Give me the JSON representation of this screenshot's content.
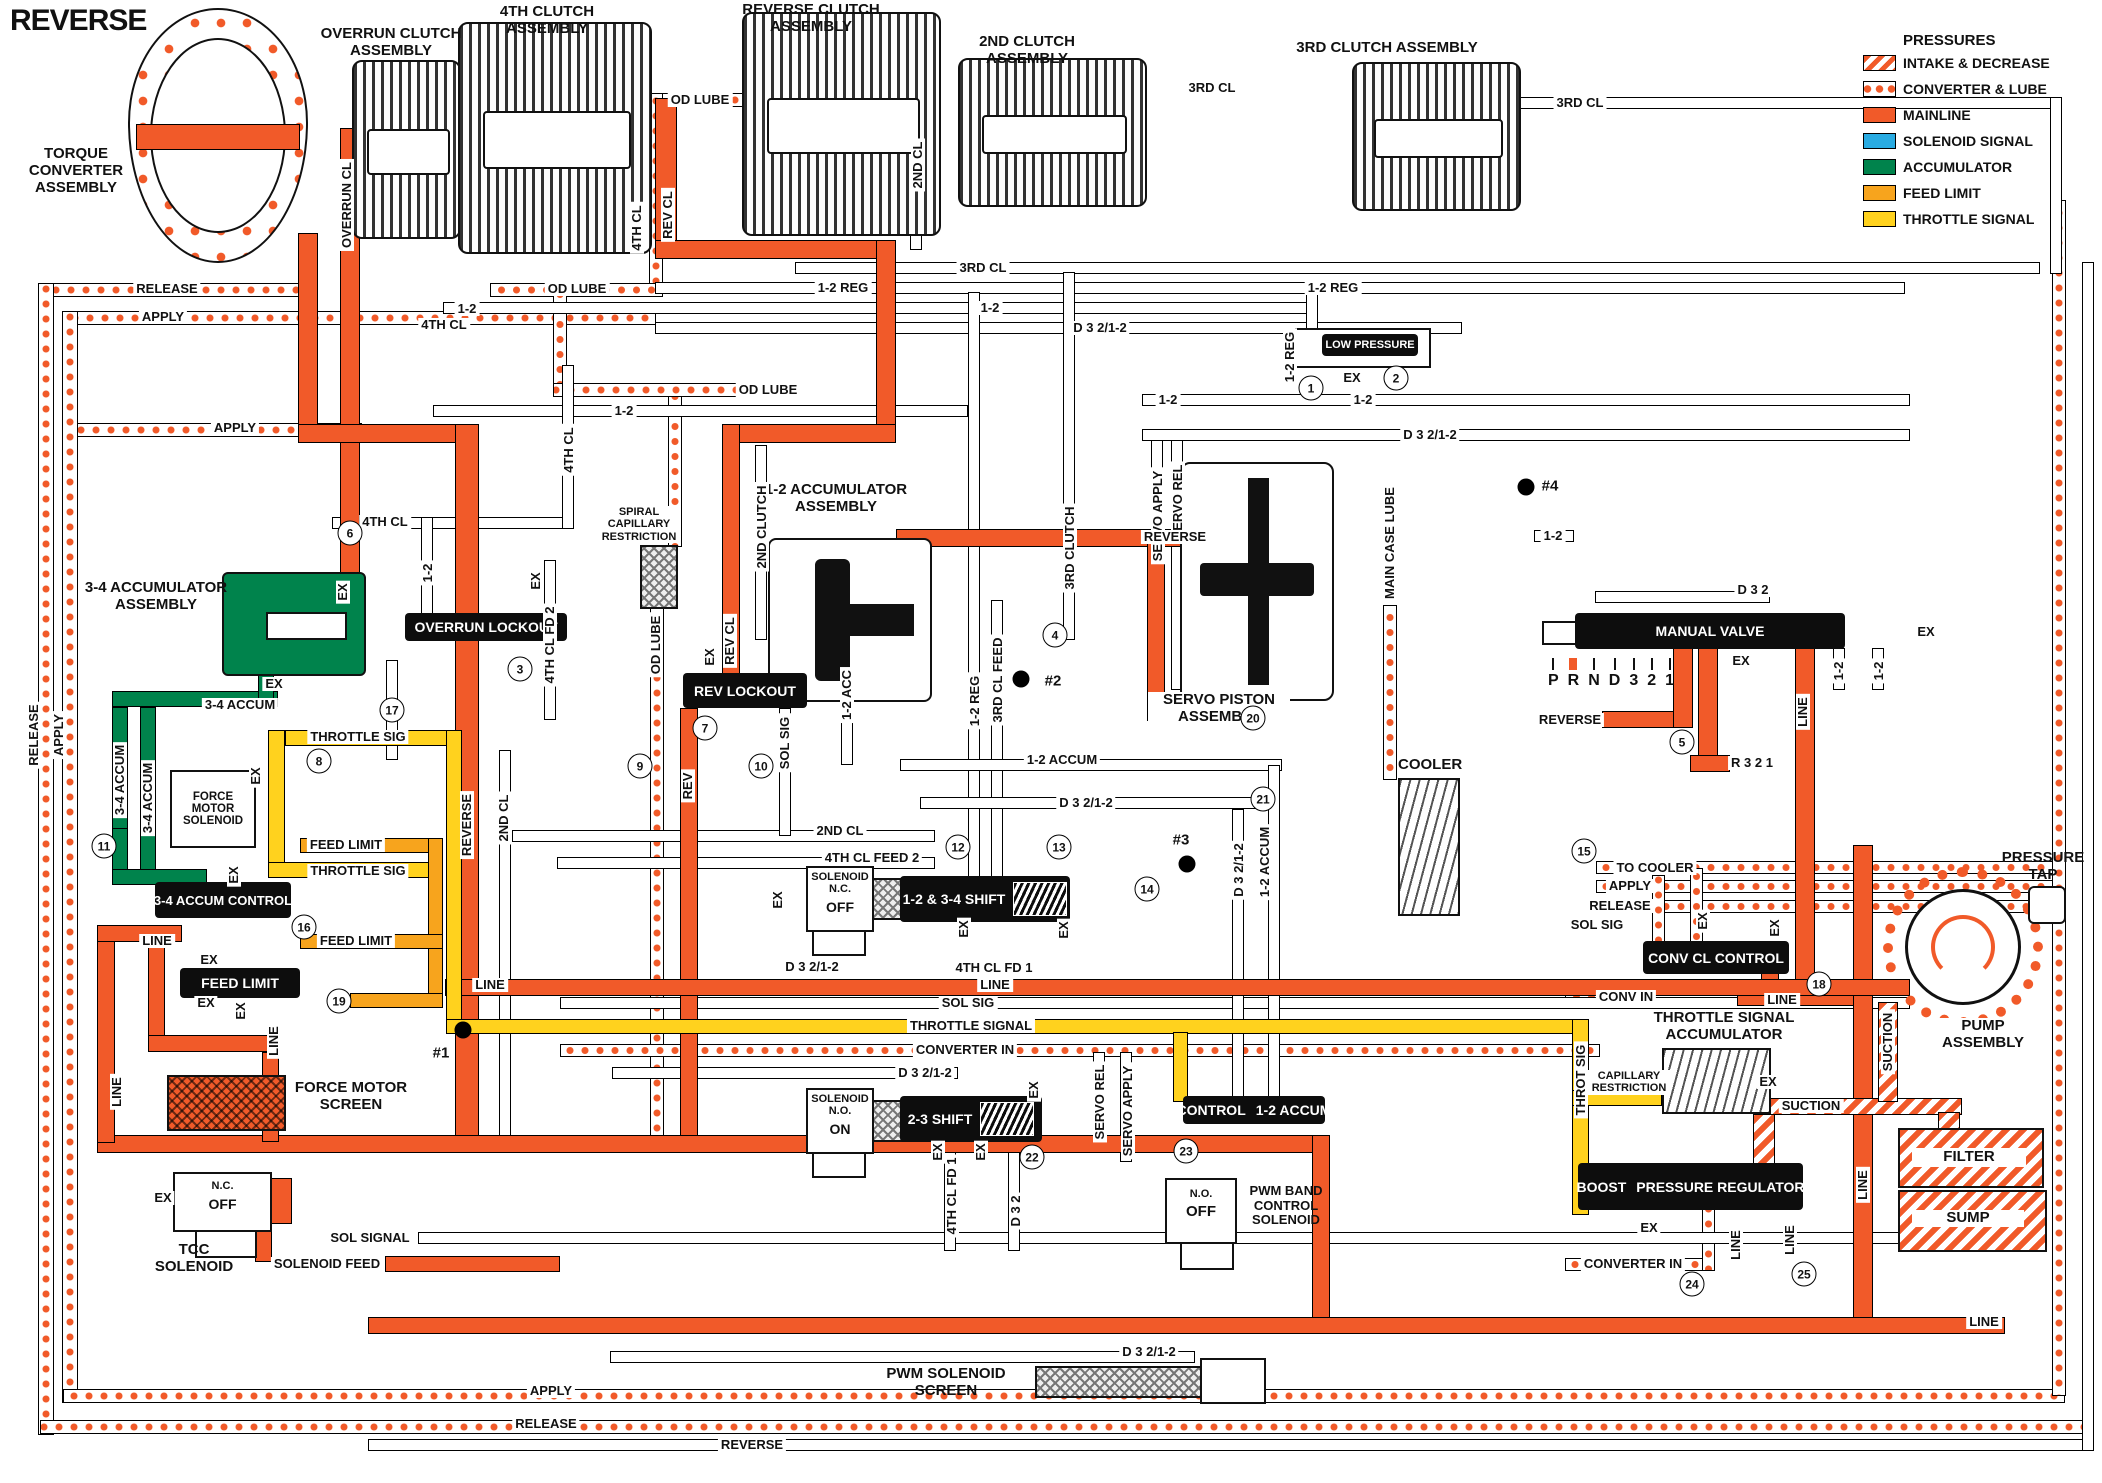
{
  "title": "REVERSE",
  "legend": {
    "title": "PRESSURES",
    "items": [
      {
        "label": "INTAKE & DECREASE",
        "type": "intake"
      },
      {
        "label": "CONVERTER & LUBE",
        "type": "conv"
      },
      {
        "label": "MAINLINE",
        "type": "main"
      },
      {
        "label": "SOLENOID SIGNAL",
        "type": "sol"
      },
      {
        "label": "ACCUMULATOR",
        "type": "accum"
      },
      {
        "label": "FEED LIMIT",
        "type": "feed"
      },
      {
        "label": "THROTTLE SIGNAL",
        "type": "throttle"
      }
    ]
  },
  "colors": {
    "mainline": "#F15A29",
    "solenoid_signal": "#29ABE2",
    "accumulator": "#00834C",
    "feed_limit": "#F7A41D",
    "throttle_signal": "#FFD21E"
  },
  "components": {
    "torque_converter": "TORQUE CONVERTER ASSEMBLY",
    "overrun_clutch": "OVERRUN CLUTCH ASSEMBLY",
    "clutch_4th": "4TH CLUTCH ASSEMBLY",
    "reverse_clutch": "REVERSE CLUTCH ASSEMBLY",
    "clutch_2nd": "2ND CLUTCH ASSEMBLY",
    "clutch_3rd": "3RD CLUTCH ASSEMBLY",
    "accum_34": "3-4 ACCUMULATOR ASSEMBLY",
    "accum_12": "1-2 ACCUMULATOR ASSEMBLY",
    "spiral_capillary": "SPIRAL CAPILLARY RESTRICTION",
    "servo_piston": "SERVO PISTON ASSEMBLY",
    "cooler": "COOLER",
    "force_motor_solenoid": "FORCE MOTOR SOLENOID",
    "force_motor_screen": "FORCE MOTOR SCREEN",
    "tcc_solenoid": "TCC SOLENOID",
    "pwm_band_solenoid": "PWM BAND CONTROL SOLENOID",
    "pwm_screen": "PWM SOLENOID SCREEN",
    "throttle_accum": "THROTTLE SIGNAL ACCUMULATOR",
    "capillary_restriction": "CAPILLARY RESTRICTION",
    "pump": "PUMP ASSEMBLY",
    "pressure_tap": "PRESSURE TAP",
    "filter": "FILTER",
    "sump": "SUMP"
  },
  "valves": {
    "overrun_lockout": "OVERRUN LOCKOUT",
    "rev_lockout": "REV LOCKOUT",
    "shift_12_34": "1-2 & 3-4 SHIFT",
    "shift_23": "2-3 SHIFT",
    "control_12_accum_a": "CONTROL",
    "control_12_accum_b": "1-2 ACCUM",
    "manual_valve": "MANUAL VALVE",
    "low_pressure": "LOW PRESSURE",
    "conv_cl_control": "CONV CL CONTROL",
    "boost_a": "BOOST",
    "boost_b": "PRESSURE REGULATOR",
    "accum_control_34": "3-4 ACCUM CONTROL",
    "feed_limit_valve": "FEED LIMIT"
  },
  "solenoids": {
    "nc_title": "SOLENOID",
    "nc_type": "N.C.",
    "nc_state": "OFF",
    "no_title": "SOLENOID",
    "no_type": "N.O.",
    "no_state": "ON",
    "pwm_type": "N.O.",
    "pwm_state": "OFF",
    "tcc_type": "N.C.",
    "tcc_state": "OFF"
  },
  "manual": {
    "positions": [
      "P",
      "R",
      "N",
      "D",
      "3",
      "2",
      "1"
    ],
    "selected": "R"
  },
  "pipe_labels": [
    {
      "t": "RELEASE",
      "x": 167,
      "y": 289
    },
    {
      "t": "APPLY",
      "x": 163,
      "y": 317
    },
    {
      "t": "APPLY",
      "x": 235,
      "y": 428
    },
    {
      "t": "RELEASE",
      "x": 34,
      "y": 735,
      "r": 1
    },
    {
      "t": "APPLY",
      "x": 59,
      "y": 735,
      "r": 1
    },
    {
      "t": "OD LUBE",
      "x": 700,
      "y": 100
    },
    {
      "t": "2ND CL",
      "x": 918,
      "y": 165,
      "r": 1
    },
    {
      "t": "3RD CL",
      "x": 1212,
      "y": 88
    },
    {
      "t": "3RD CL",
      "x": 1580,
      "y": 103
    },
    {
      "t": "REV CL",
      "x": 668,
      "y": 215,
      "r": 1
    },
    {
      "t": "4TH CL",
      "x": 637,
      "y": 228,
      "r": 1
    },
    {
      "t": "OVERRUN CL",
      "x": 347,
      "y": 205,
      "r": 1
    },
    {
      "t": "OD LUBE",
      "x": 577,
      "y": 289
    },
    {
      "t": "1-2",
      "x": 467,
      "y": 309
    },
    {
      "t": "3RD CL",
      "x": 983,
      "y": 268
    },
    {
      "t": "1-2 REG",
      "x": 843,
      "y": 288
    },
    {
      "t": "1-2 REG",
      "x": 1333,
      "y": 288
    },
    {
      "t": "1-2",
      "x": 990,
      "y": 308
    },
    {
      "t": "D 3 2/1-2",
      "x": 1100,
      "y": 328
    },
    {
      "t": "1-2",
      "x": 624,
      "y": 411
    },
    {
      "t": "4TH CL",
      "x": 444,
      "y": 325
    },
    {
      "t": "4TH CL",
      "x": 569,
      "y": 450,
      "r": 1
    },
    {
      "t": "4TH CL",
      "x": 385,
      "y": 522
    },
    {
      "t": "1-2",
      "x": 428,
      "y": 573,
      "r": 1
    },
    {
      "t": "4TH CL FD 2",
      "x": 550,
      "y": 645,
      "r": 1
    },
    {
      "t": "EX",
      "x": 536,
      "y": 581,
      "r": 1
    },
    {
      "t": "EX",
      "x": 343,
      "y": 592,
      "r": 1
    },
    {
      "t": "OD LUBE",
      "x": 768,
      "y": 390
    },
    {
      "t": "OD LUBE",
      "x": 656,
      "y": 645,
      "r": 1
    },
    {
      "t": "2ND CLUTCH",
      "x": 762,
      "y": 527,
      "r": 1
    },
    {
      "t": "REV CL",
      "x": 730,
      "y": 641,
      "r": 1
    },
    {
      "t": "EX",
      "x": 710,
      "y": 657,
      "r": 1
    },
    {
      "t": "1-2 ACC",
      "x": 847,
      "y": 695,
      "r": 1
    },
    {
      "t": "SOL SIG",
      "x": 785,
      "y": 743,
      "r": 1
    },
    {
      "t": "REV",
      "x": 688,
      "y": 786,
      "r": 1
    },
    {
      "t": "EX",
      "x": 778,
      "y": 900,
      "r": 1
    },
    {
      "t": "2ND CL",
      "x": 840,
      "y": 831
    },
    {
      "t": "4TH CL FEED 2",
      "x": 872,
      "y": 858
    },
    {
      "t": "D 3 2/1-2",
      "x": 812,
      "y": 967
    },
    {
      "t": "4TH CL FD 1",
      "x": 994,
      "y": 968
    },
    {
      "t": "SOL SIG",
      "x": 968,
      "y": 1003
    },
    {
      "t": "THROTTLE SIGNAL",
      "x": 971,
      "y": 1026
    },
    {
      "t": "CONVERTER IN",
      "x": 965,
      "y": 1050
    },
    {
      "t": "D 3 2/1-2",
      "x": 925,
      "y": 1073
    },
    {
      "t": "EX",
      "x": 964,
      "y": 929,
      "r": 1
    },
    {
      "t": "EX",
      "x": 1064,
      "y": 930,
      "r": 1
    },
    {
      "t": "EX",
      "x": 938,
      "y": 1152,
      "r": 1
    },
    {
      "t": "EX",
      "x": 981,
      "y": 1152,
      "r": 1
    },
    {
      "t": "EX",
      "x": 1034,
      "y": 1090,
      "r": 1
    },
    {
      "t": "4TH CL FD 1",
      "x": 952,
      "y": 1196,
      "r": 1
    },
    {
      "t": "D 3 2",
      "x": 1016,
      "y": 1211,
      "r": 1
    },
    {
      "t": "SERVO REL",
      "x": 1100,
      "y": 1102,
      "r": 1
    },
    {
      "t": "SERVO APPLY",
      "x": 1128,
      "y": 1111,
      "r": 1
    },
    {
      "t": "1-2 REG",
      "x": 975,
      "y": 701,
      "r": 1
    },
    {
      "t": "3RD CL FEED",
      "x": 998,
      "y": 680,
      "r": 1
    },
    {
      "t": "3RD CLUTCH",
      "x": 1070,
      "y": 548,
      "r": 1
    },
    {
      "t": "SERVO APPLY",
      "x": 1158,
      "y": 516,
      "r": 1
    },
    {
      "t": "SERVO REL",
      "x": 1178,
      "y": 502,
      "r": 1
    },
    {
      "t": "1-2 ACCUM",
      "x": 1062,
      "y": 760
    },
    {
      "t": "D 3 2/1-2",
      "x": 1086,
      "y": 803
    },
    {
      "t": "1-2 ACCUM",
      "x": 1265,
      "y": 862,
      "r": 1
    },
    {
      "t": "D 3 2/1-2",
      "x": 1239,
      "y": 870,
      "r": 1
    },
    {
      "t": "MAIN CASE LUBE",
      "x": 1390,
      "y": 543,
      "r": 1
    },
    {
      "t": "D 3 2/1-2",
      "x": 1430,
      "y": 435
    },
    {
      "t": "1-2",
      "x": 1553,
      "y": 536
    },
    {
      "t": "1-2",
      "x": 1168,
      "y": 400
    },
    {
      "t": "1-2",
      "x": 1363,
      "y": 400
    },
    {
      "t": "1-2 REG",
      "x": 1290,
      "y": 357,
      "r": 1
    },
    {
      "t": "EX",
      "x": 1352,
      "y": 378
    },
    {
      "t": "D 3 2",
      "x": 1753,
      "y": 590
    },
    {
      "t": "EX",
      "x": 1741,
      "y": 661
    },
    {
      "t": "EX",
      "x": 1926,
      "y": 632
    },
    {
      "t": "REVERSE",
      "x": 1570,
      "y": 720
    },
    {
      "t": "R 3 2 1",
      "x": 1752,
      "y": 763
    },
    {
      "t": "LINE",
      "x": 1803,
      "y": 712,
      "r": 1
    },
    {
      "t": "1-2",
      "x": 1839,
      "y": 671,
      "r": 1
    },
    {
      "t": "1-2",
      "x": 1879,
      "y": 671,
      "r": 1
    },
    {
      "t": "REVERSE",
      "x": 1175,
      "y": 537
    },
    {
      "t": "REVERSE",
      "x": 467,
      "y": 825,
      "r": 1
    },
    {
      "t": "2ND CL",
      "x": 504,
      "y": 818,
      "r": 1
    },
    {
      "t": "LINE",
      "x": 157,
      "y": 941
    },
    {
      "t": "LINE",
      "x": 117,
      "y": 1092,
      "r": 1
    },
    {
      "t": "LINE",
      "x": 274,
      "y": 1041,
      "r": 1
    },
    {
      "t": "3-4 ACCUM",
      "x": 240,
      "y": 705
    },
    {
      "t": "3-4 ACCUM",
      "x": 120,
      "y": 780,
      "r": 1
    },
    {
      "t": "3-4 ACCUM",
      "x": 148,
      "y": 798,
      "r": 1
    },
    {
      "t": "EX",
      "x": 274,
      "y": 684
    },
    {
      "t": "EX",
      "x": 256,
      "y": 776,
      "r": 1
    },
    {
      "t": "THROTTLE SIG",
      "x": 358,
      "y": 737
    },
    {
      "t": "FEED LIMIT",
      "x": 346,
      "y": 845
    },
    {
      "t": "THROTTLE SIG",
      "x": 358,
      "y": 871
    },
    {
      "t": "FEED LIMIT",
      "x": 356,
      "y": 941
    },
    {
      "t": "EX",
      "x": 234,
      "y": 875,
      "r": 1
    },
    {
      "t": "EX",
      "x": 209,
      "y": 960
    },
    {
      "t": "EX",
      "x": 206,
      "y": 1003
    },
    {
      "t": "EX",
      "x": 241,
      "y": 1011,
      "r": 1
    },
    {
      "t": "EX",
      "x": 163,
      "y": 1198
    },
    {
      "t": "SOL SIGNAL",
      "x": 370,
      "y": 1238
    },
    {
      "t": "SOLENOID FEED",
      "x": 327,
      "y": 1264
    },
    {
      "t": "LINE",
      "x": 490,
      "y": 985
    },
    {
      "t": "LINE",
      "x": 995,
      "y": 985
    },
    {
      "t": "APPLY",
      "x": 551,
      "y": 1391
    },
    {
      "t": "RELEASE",
      "x": 546,
      "y": 1424
    },
    {
      "t": "REVERSE",
      "x": 752,
      "y": 1445
    },
    {
      "t": "D 3 2/1-2",
      "x": 1149,
      "y": 1352
    },
    {
      "t": "LINE",
      "x": 1984,
      "y": 1322
    },
    {
      "t": "TO COOLER",
      "x": 1655,
      "y": 868
    },
    {
      "t": "APPLY",
      "x": 1630,
      "y": 886
    },
    {
      "t": "RELEASE",
      "x": 1620,
      "y": 906
    },
    {
      "t": "SOL SIG",
      "x": 1597,
      "y": 925
    },
    {
      "t": "CONV IN",
      "x": 1626,
      "y": 997
    },
    {
      "t": "LINE",
      "x": 1782,
      "y": 1000
    },
    {
      "t": "EX",
      "x": 1703,
      "y": 921,
      "r": 1
    },
    {
      "t": "EX",
      "x": 1775,
      "y": 928,
      "r": 1
    },
    {
      "t": "THROT SIG",
      "x": 1581,
      "y": 1080,
      "r": 1
    },
    {
      "t": "EX",
      "x": 1768,
      "y": 1082
    },
    {
      "t": "SUCTION",
      "x": 1888,
      "y": 1042,
      "r": 1
    },
    {
      "t": "SUCTION",
      "x": 1811,
      "y": 1106
    },
    {
      "t": "CONVERTER IN",
      "x": 1633,
      "y": 1264
    },
    {
      "t": "LINE",
      "x": 1736,
      "y": 1245,
      "r": 1
    },
    {
      "t": "LINE",
      "x": 1790,
      "y": 1240,
      "r": 1
    },
    {
      "t": "LINE",
      "x": 1863,
      "y": 1185,
      "r": 1
    },
    {
      "t": "EX",
      "x": 1649,
      "y": 1228
    }
  ],
  "circles": [
    {
      "n": "1",
      "x": 1311,
      "y": 388
    },
    {
      "n": "2",
      "x": 1396,
      "y": 378
    },
    {
      "n": "3",
      "x": 520,
      "y": 669
    },
    {
      "n": "4",
      "x": 1055,
      "y": 635
    },
    {
      "n": "5",
      "x": 1682,
      "y": 742
    },
    {
      "n": "6",
      "x": 350,
      "y": 533
    },
    {
      "n": "7",
      "x": 705,
      "y": 728
    },
    {
      "n": "8",
      "x": 319,
      "y": 761
    },
    {
      "n": "9",
      "x": 640,
      "y": 766
    },
    {
      "n": "10",
      "x": 761,
      "y": 766
    },
    {
      "n": "11",
      "x": 104,
      "y": 846
    },
    {
      "n": "12",
      "x": 958,
      "y": 847
    },
    {
      "n": "13",
      "x": 1059,
      "y": 847
    },
    {
      "n": "14",
      "x": 1147,
      "y": 889
    },
    {
      "n": "15",
      "x": 1584,
      "y": 851
    },
    {
      "n": "16",
      "x": 304,
      "y": 927
    },
    {
      "n": "17",
      "x": 392,
      "y": 710
    },
    {
      "n": "18",
      "x": 1819,
      "y": 984
    },
    {
      "n": "19",
      "x": 339,
      "y": 1001
    },
    {
      "n": "20",
      "x": 1253,
      "y": 718
    },
    {
      "n": "21",
      "x": 1263,
      "y": 799
    },
    {
      "n": "22",
      "x": 1032,
      "y": 1157
    },
    {
      "n": "23",
      "x": 1186,
      "y": 1151
    },
    {
      "n": "24",
      "x": 1692,
      "y": 1284
    },
    {
      "n": "25",
      "x": 1804,
      "y": 1274
    }
  ],
  "checkballs": [
    {
      "label": "#1",
      "x": 463,
      "y": 1030,
      "tx": 441,
      "ty": 1053
    },
    {
      "label": "#2",
      "x": 1021,
      "y": 679,
      "tx": 1053,
      "ty": 681
    },
    {
      "label": "#3",
      "x": 1187,
      "y": 864,
      "tx": 1181,
      "ty": 840
    },
    {
      "label": "#4",
      "x": 1526,
      "y": 487,
      "tx": 1550,
      "ty": 486
    }
  ]
}
